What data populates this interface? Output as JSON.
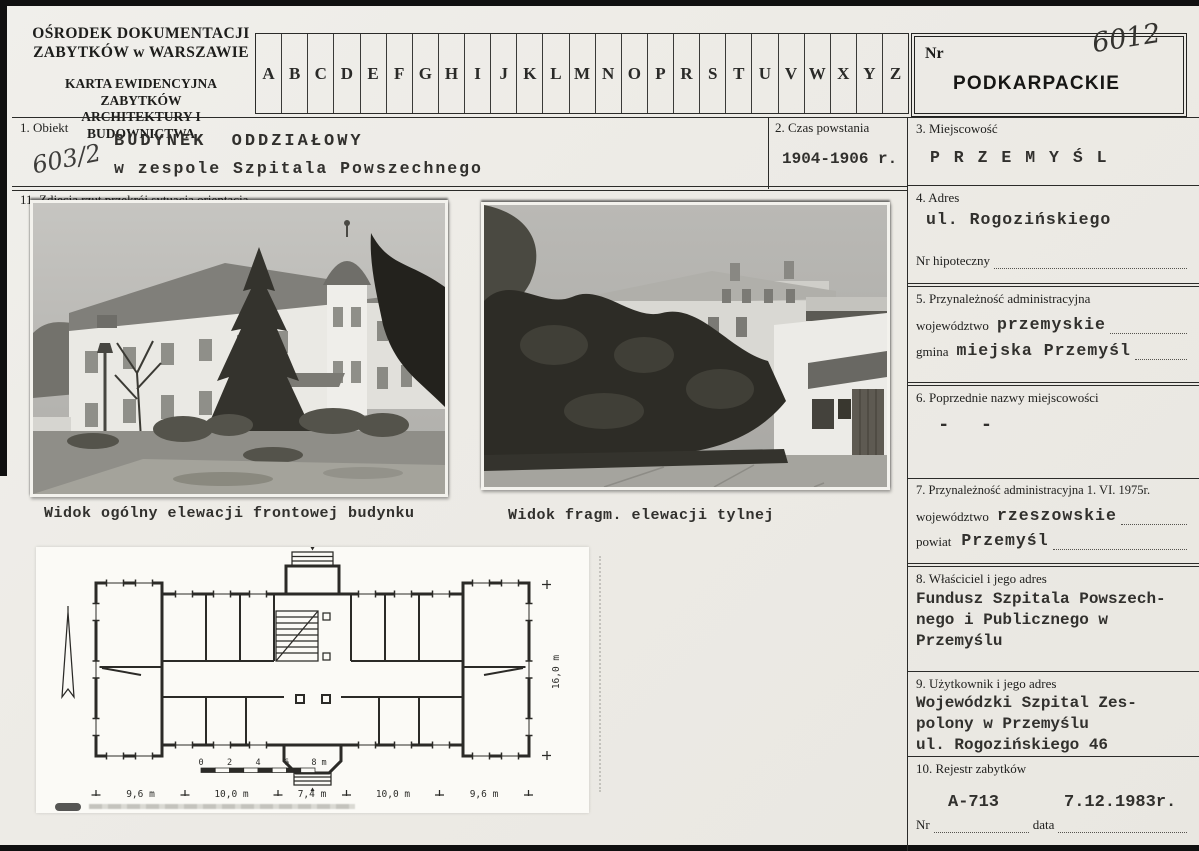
{
  "header": {
    "org_line1": "OŚRODEK  DOKUMENTACJI",
    "org_line2": "ZABYTKÓW  w  WARSZAWIE",
    "card_line1": "KARTA EWIDENCYJNA ZABYTKÓW",
    "card_line2": "ARCHITEKTURY  I  BUDOWNICTWA",
    "alphabet": [
      "A",
      "B",
      "C",
      "D",
      "E",
      "F",
      "G",
      "H",
      "I",
      "J",
      "K",
      "L",
      "M",
      "N",
      "O",
      "P",
      "R",
      "S",
      "T",
      "U",
      "V",
      "W",
      "X",
      "Y",
      "Z"
    ],
    "nr_label": "Nr",
    "nr_handwritten": "6012",
    "voivodeship_stamp": "PODKARPACKIE"
  },
  "fields": {
    "f1": {
      "label": "1. Obiekt",
      "value_line1": "BUDYNEK  ODDZIAŁOWY",
      "value_line2": "w zespole Szpitala Powszechnego",
      "annotation": "603/2"
    },
    "f2": {
      "label": "2. Czas powstania",
      "value": "1904-1906 r."
    },
    "f3": {
      "label": "3. Miejscowość",
      "value": "P R Z E M Y Ś L"
    },
    "f4": {
      "label": "4. Adres",
      "value": "ul. Rogozińskiego",
      "sub_label": "Nr hipoteczny"
    },
    "f5": {
      "label": "5. Przynależność administracyjna",
      "rows": [
        {
          "label": "województwo",
          "value": "przemyskie"
        },
        {
          "label": "gmina",
          "value": "miejska Przemyśl"
        }
      ]
    },
    "f6": {
      "label": "6. Poprzednie nazwy miejscowości",
      "value": "- -"
    },
    "f7": {
      "label": "7. Przynależność administracyjna 1. VI. 1975r.",
      "rows": [
        {
          "label": "województwo",
          "value": "rzeszowskie"
        },
        {
          "label": "powiat",
          "value": "Przemyśl"
        }
      ]
    },
    "f8": {
      "label": "8. Właściciel i jego adres",
      "value_lines": [
        "Fundusz Szpitala Powszech-",
        "nego i Publicznego w",
        "Przemyślu"
      ]
    },
    "f9": {
      "label": "9. Użytkownik i jego adres",
      "value_lines": [
        "Wojewódzki Szpital Zes-",
        "polony w Przemyślu",
        "ul. Rogozińskiego 46"
      ]
    },
    "f10": {
      "label": "10. Rejestr zabytków",
      "register_number": "A-713",
      "register_date": "7.12.1983r.",
      "nr_label": "Nr",
      "date_label": "data"
    },
    "f11": {
      "label": "11. Zdjęcia rzut przekrój sytuacja orientacja"
    }
  },
  "photos": [
    {
      "caption": "Widok ogólny elewacji frontowej budynku"
    },
    {
      "caption": "Widok fragm. elewacji tylnej"
    }
  ],
  "plan": {
    "dims_bottom": [
      "9,6 m",
      "10,0 m",
      "7,4 m",
      "10,0 m",
      "9,6 m"
    ],
    "dim_right": "16,0 m",
    "scale_ticks": [
      "0",
      "2",
      "4",
      "6",
      "8 m"
    ]
  }
}
